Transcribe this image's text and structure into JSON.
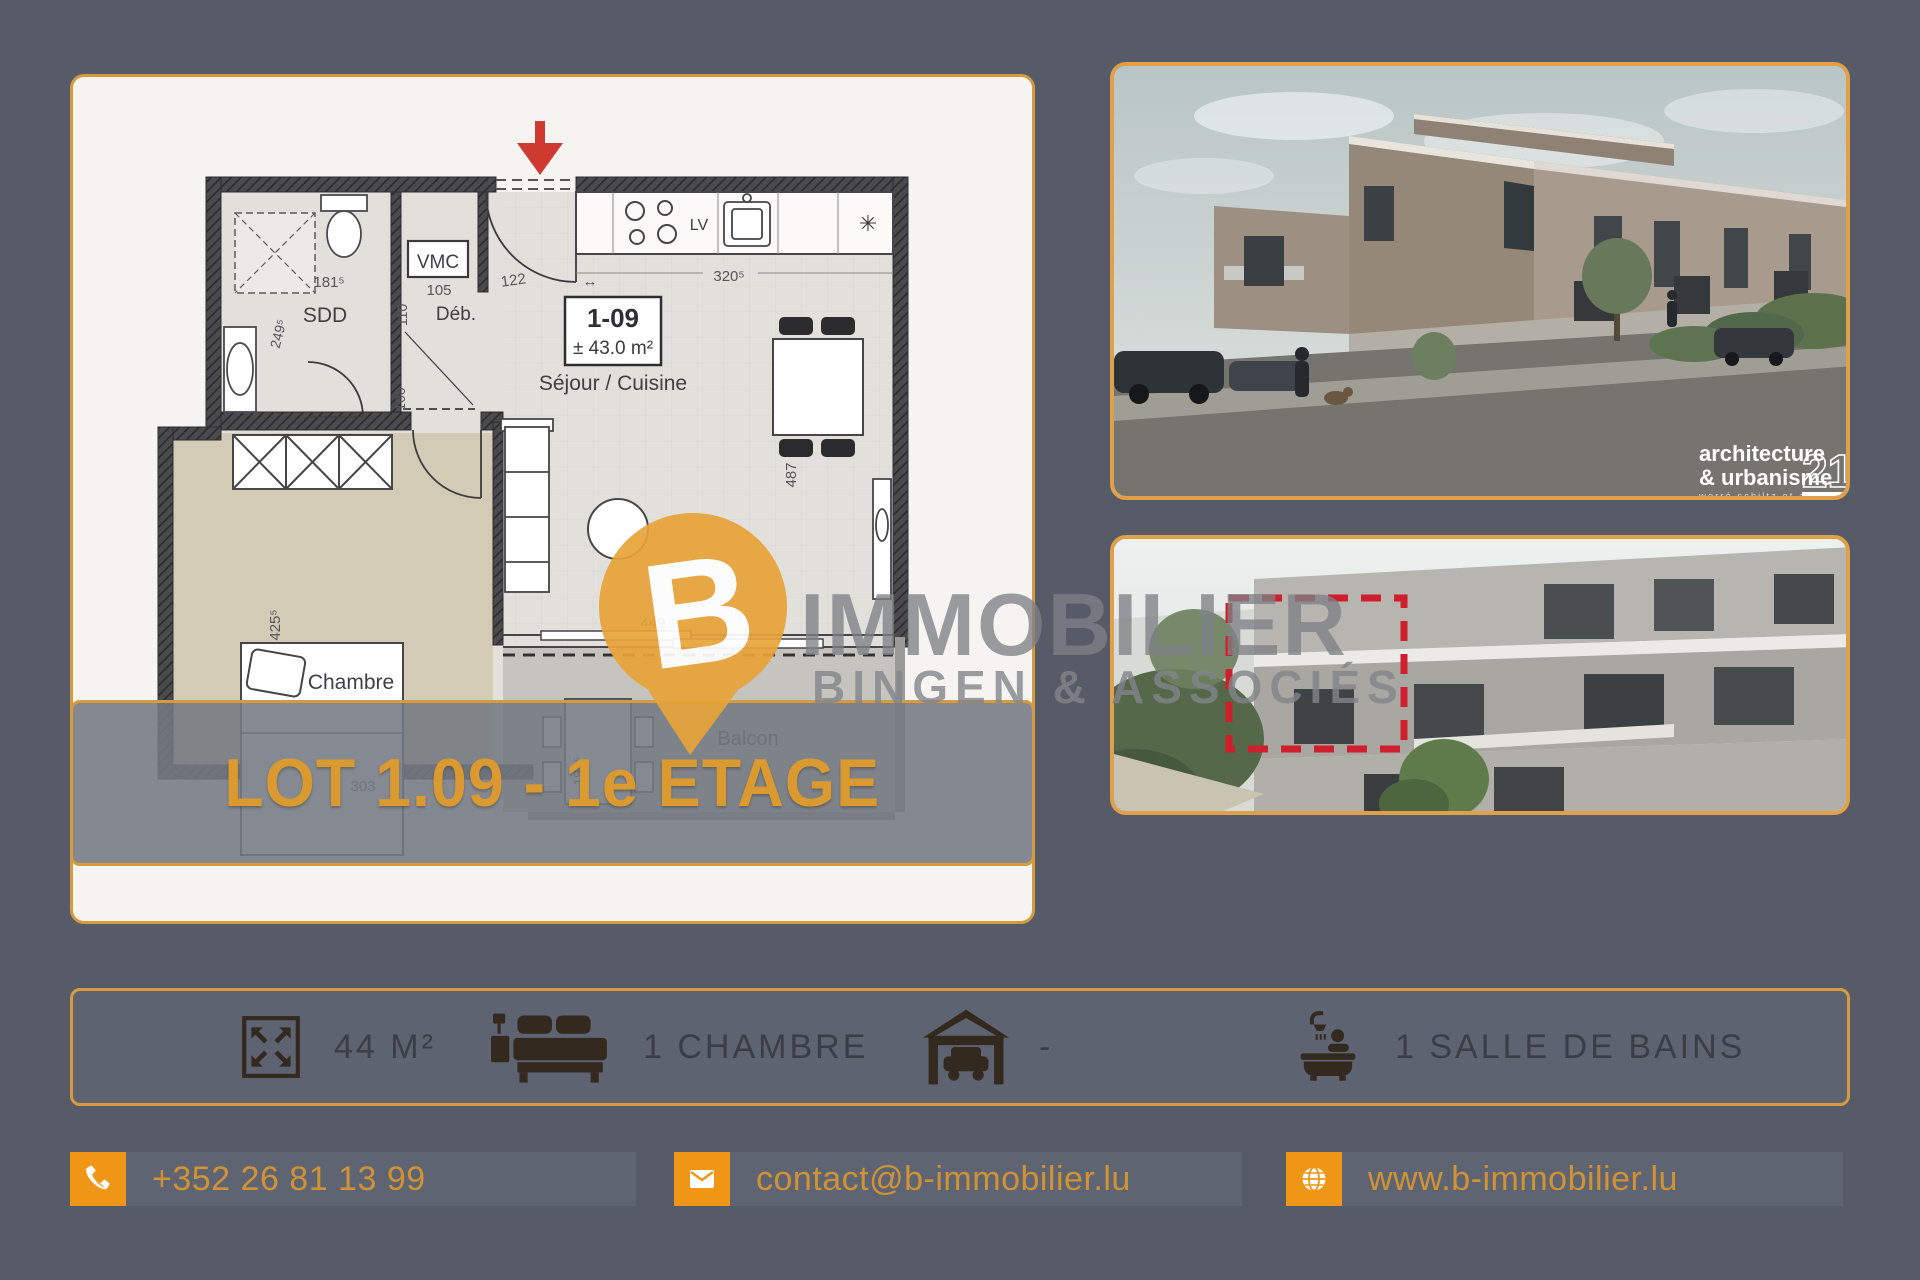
{
  "page": {
    "background": "#565B67",
    "accent_orange": "#EF9617",
    "border_orange": "#D79B3F"
  },
  "floorplan": {
    "banner": "LOT 1.09 - 1e ETAGE",
    "unit": {
      "id": "1-09",
      "area": "± 43.0 m²"
    },
    "labels": {
      "living": "Séjour / Cuisine",
      "bedroom": "Chambre",
      "balcony": "Balcon",
      "shower_room": "SDD",
      "storage": "Déb.",
      "vent": "VMC",
      "dishwasher": "LV"
    },
    "dims": {
      "d181": "181⁵",
      "d249": "249⁵",
      "d105": "105",
      "d110": "110",
      "d100": "100",
      "d122": "122",
      "d320": "320⁵",
      "d487": "487",
      "d449": "449",
      "d425": "425⁵",
      "d303": "303",
      "d199": "199⁵"
    },
    "misc": {
      "freezer": "✳",
      "door_span": "↔"
    }
  },
  "watermark": {
    "pin_letter": "B",
    "line1": "IMMOBILIER",
    "line2": "BINGEN & ASSOCIÉS"
  },
  "photo_caption": {
    "line1": "architecture",
    "line2": "& urbanisme",
    "number": "21",
    "sub": "worré schiltz et associés"
  },
  "features": [
    {
      "icon": "area-expand-icon",
      "label": "44 M²"
    },
    {
      "icon": "bed-icon",
      "label": "1 CHAMBRE"
    },
    {
      "icon": "garage-icon",
      "label": "-"
    },
    {
      "icon": "bath-icon",
      "label": "1 SALLE DE BAINS"
    }
  ],
  "contact": {
    "phone": "+352 26 81 13 99",
    "email": "contact@b-immobilier.lu",
    "website": "www.b-immobilier.lu"
  }
}
